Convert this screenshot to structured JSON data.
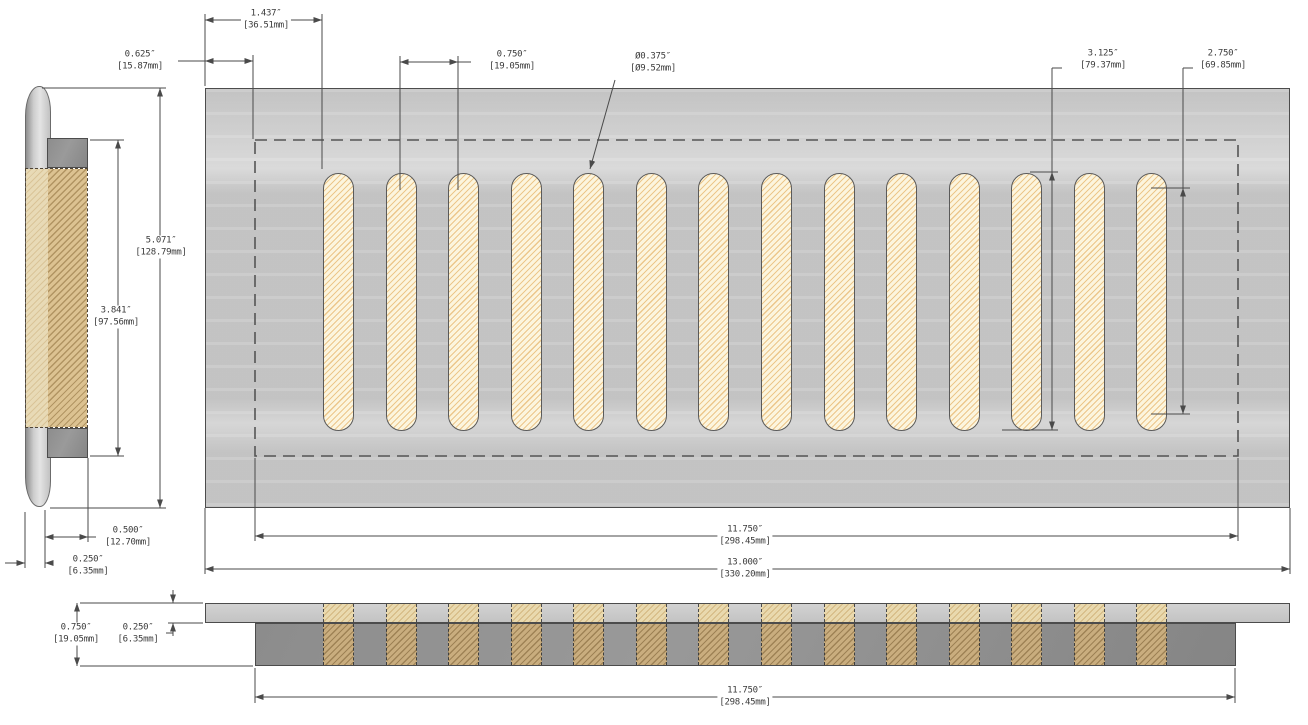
{
  "drawing": {
    "type": "technical-dimension-drawing",
    "subject": "slotted vent register plate, three views (side profile, top, cross-section)",
    "units": "inches [millimeters]"
  },
  "geometry": {
    "slot_count": 14
  },
  "dims": {
    "edge_to_slot": {
      "in": "1.437″",
      "mm": "[36.51mm]"
    },
    "duct_inset": {
      "in": "0.625″",
      "mm": "[15.87mm]"
    },
    "slot_pitch": {
      "in": "0.750″",
      "mm": "[19.05mm]"
    },
    "slot_dia": {
      "in": "Ø0.375″",
      "mm": "[Ø9.52mm]"
    },
    "slot_length": {
      "in": "3.125″",
      "mm": "[79.37mm]"
    },
    "slot_straight": {
      "in": "2.750″",
      "mm": "[69.85mm]"
    },
    "duct_width": {
      "in": "11.750″",
      "mm": "[298.45mm]"
    },
    "plate_width": {
      "in": "13.000″",
      "mm": "[330.20mm]"
    },
    "plate_height": {
      "in": "5.071″",
      "mm": "[128.79mm]"
    },
    "opening_height": {
      "in": "3.841″",
      "mm": "[97.56mm]"
    },
    "frame_depth": {
      "in": "0.500″",
      "mm": "[12.70mm]"
    },
    "flange_thick": {
      "in": "0.250″",
      "mm": "[6.35mm]"
    },
    "body_height": {
      "in": "0.750″",
      "mm": "[19.05mm]"
    },
    "plate_thick": {
      "in": "0.250″",
      "mm": "[6.35mm]"
    },
    "duct_width_sec": {
      "in": "11.750″",
      "mm": "[298.45mm]"
    }
  },
  "colors": {
    "plate_gray": "#c8c8c8",
    "frame_dark_gray": "#8d8d8d",
    "slot_cream": "#fcf5de",
    "hatch_tan": "#e2a854",
    "duct_tan": "#dcc291",
    "line_color": "#4a4a4a"
  }
}
